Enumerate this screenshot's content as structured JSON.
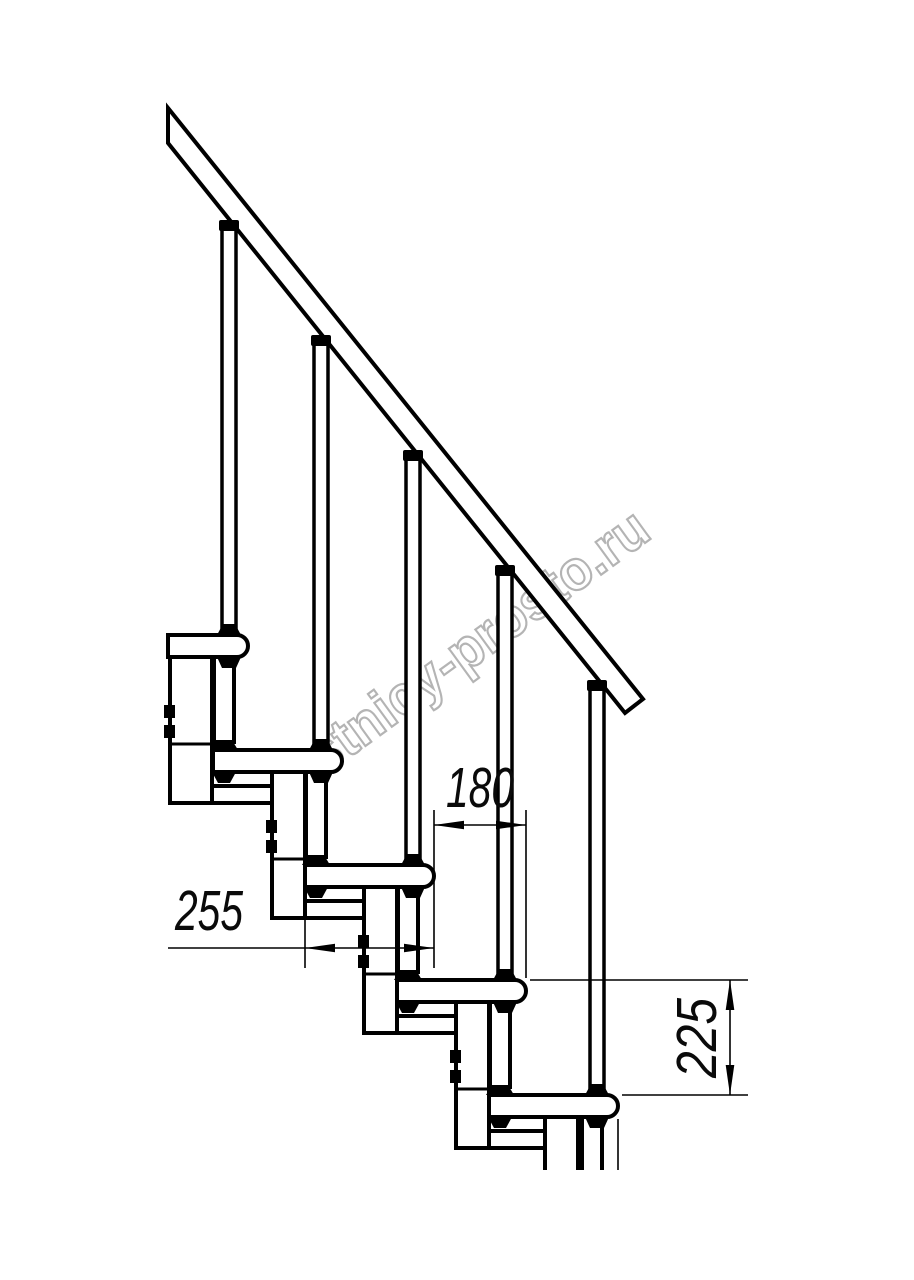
{
  "watermark": "lestnicy-prosto.ru",
  "dimensions": {
    "step_run_label": "180",
    "tread_depth_label": "255",
    "step_height_label": "225"
  },
  "structure": {
    "treads_visible": 5,
    "balusters_visible": 5
  }
}
